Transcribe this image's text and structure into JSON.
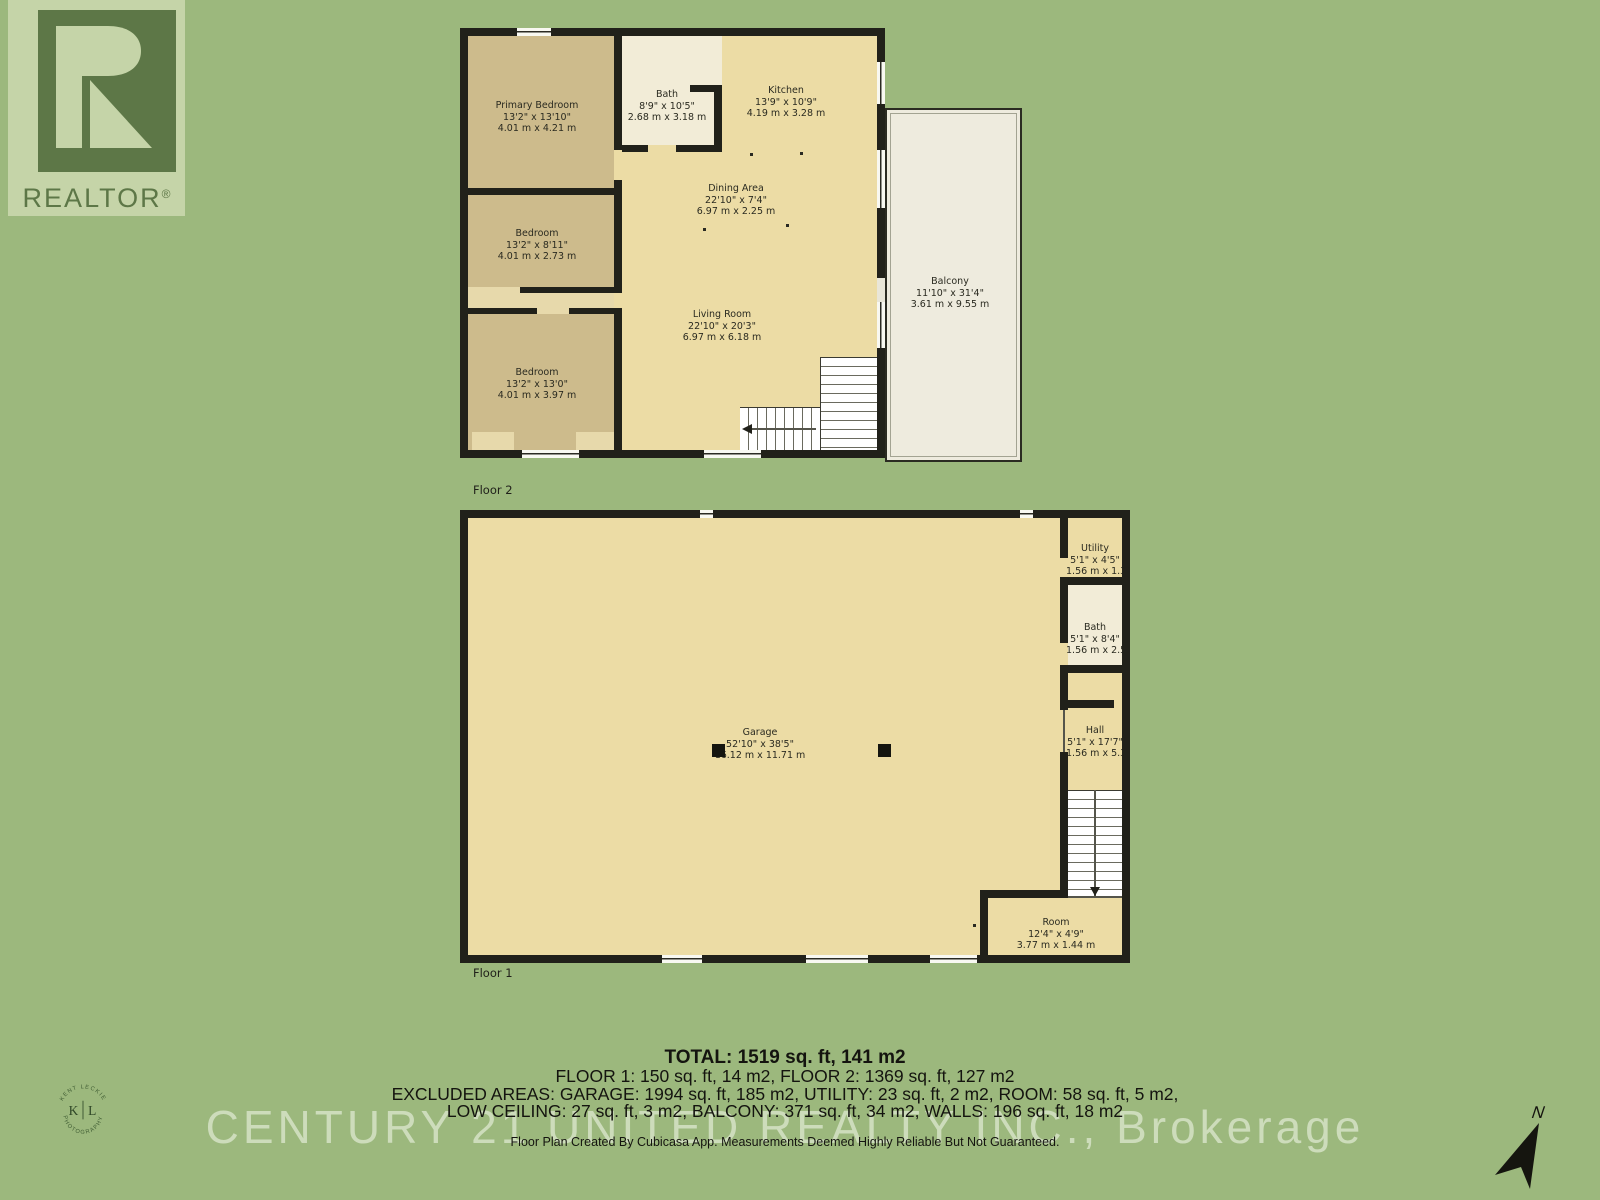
{
  "colors": {
    "background": "#9cb87d",
    "floor_fill": "#ecdca5",
    "bedroom_fill": "#cdbb8c",
    "bath_fill": "#f2ecd7",
    "balcony_fill": "#eeebde",
    "wall": "#21211a",
    "logo_green": "#5d7747"
  },
  "watermarks": {
    "realtor": {
      "label": "REALTOR",
      "registered": "®"
    },
    "century21": "CENTURY 21 UNITED REALTY INC., Brokerage",
    "photographer": {
      "arc_top": "KENT LECKIE",
      "arc_bottom": "PHOTOGRAPHY",
      "initial_left": "K",
      "initial_right": "L"
    },
    "north": "N"
  },
  "floor2": {
    "label": "Floor 2",
    "rooms": [
      {
        "name": "Primary Bedroom",
        "dim_ft": "13'2\" x 13'10\"",
        "dim_m": "4.01 m x 4.21 m"
      },
      {
        "name": "Bath",
        "dim_ft": "8'9\" x 10'5\"",
        "dim_m": "2.68 m x 3.18 m"
      },
      {
        "name": "Kitchen",
        "dim_ft": "13'9\" x 10'9\"",
        "dim_m": "4.19 m x 3.28 m"
      },
      {
        "name": "Dining Area",
        "dim_ft": "22'10\" x 7'4\"",
        "dim_m": "6.97 m x 2.25 m"
      },
      {
        "name": "Living Room",
        "dim_ft": "22'10\" x 20'3\"",
        "dim_m": "6.97 m x 6.18 m"
      },
      {
        "name": "Bedroom",
        "dim_ft": "13'2\" x 8'11\"",
        "dim_m": "4.01 m x 2.73 m"
      },
      {
        "name": "Bedroom",
        "dim_ft": "13'2\" x 13'0\"",
        "dim_m": "4.01 m x 3.97 m"
      },
      {
        "name": "Balcony",
        "dim_ft": "11'10\" x 31'4\"",
        "dim_m": "3.61 m x 9.55 m"
      }
    ]
  },
  "floor1": {
    "label": "Floor 1",
    "rooms": [
      {
        "name": "Garage",
        "dim_ft": "52'10\" x 38'5\"",
        "dim_m": "16.12 m x 11.71 m"
      },
      {
        "name": "Utility",
        "dim_ft": "5'1\" x 4'5\"",
        "dim_m": "1.56 m x 1.36 m"
      },
      {
        "name": "Bath",
        "dim_ft": "5'1\" x 8'4\"",
        "dim_m": "1.56 m x 2.53 m"
      },
      {
        "name": "Hall",
        "dim_ft": "5'1\" x 17'7\"",
        "dim_m": "1.56 m x 5.36 m"
      },
      {
        "name": "Room",
        "dim_ft": "12'4\" x 4'9\"",
        "dim_m": "3.77 m x 1.44 m"
      }
    ]
  },
  "summary": {
    "total": "TOTAL: 1519 sq. ft, 141 m2",
    "floors": "FLOOR 1: 150 sq. ft, 14 m2, FLOOR 2: 1369 sq. ft, 127 m2",
    "excluded_1": "EXCLUDED AREAS: GARAGE: 1994 sq. ft, 185 m2, UTILITY: 23 sq. ft, 2 m2, ROOM: 58 sq. ft, 5 m2,",
    "excluded_2": "LOW CEILING: 27 sq. ft, 3 m2, BALCONY: 371 sq. ft, 34 m2, WALLS: 196 sq. ft, 18 m2",
    "disclaimer": "Floor Plan Created By Cubicasa App. Measurements Deemed Highly Reliable But Not Guaranteed."
  }
}
